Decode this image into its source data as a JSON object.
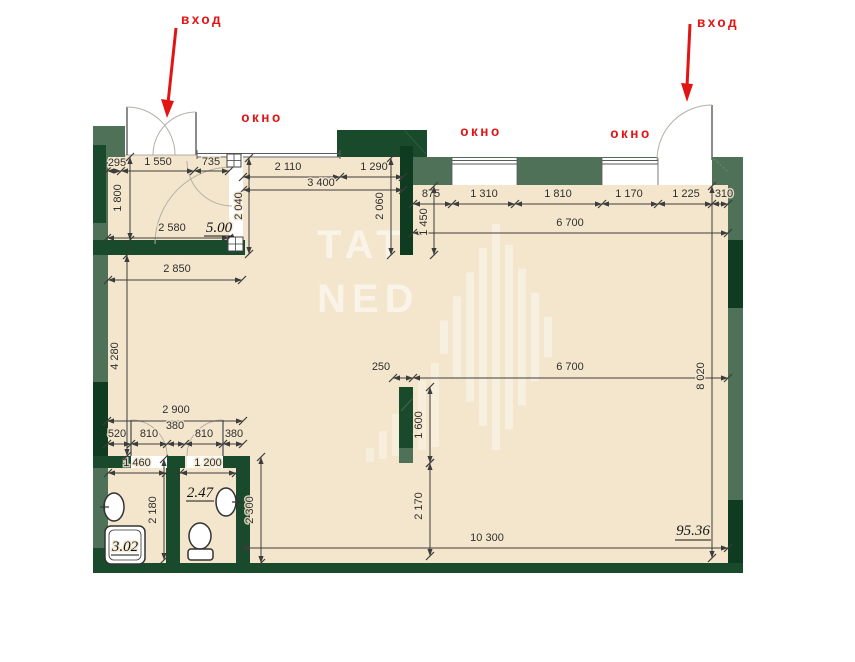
{
  "labels": {
    "entrance_left": "вход",
    "entrance_right": "вход",
    "window_1": "окно",
    "window_2": "окно",
    "window_3": "окно"
  },
  "areas": {
    "vestibule": "5.00",
    "shower_room": "3.02",
    "wc": "2.47",
    "main_room": "95.36"
  },
  "watermark": {
    "line1": "TAT",
    "line2": "NED"
  },
  "dims": {
    "d295": "295",
    "d1550": "1 550",
    "d735": "735",
    "d1800": "1 800",
    "d2580": "2 580",
    "d2040": "2 040",
    "d2110": "2 110",
    "d1290": "1 290",
    "d3400": "3 400",
    "d875": "875",
    "d1310": "1 310",
    "d1810": "1 810",
    "d1170": "1 170",
    "d1225": "1 225",
    "d310": "310",
    "d2060": "2 060",
    "d1450": "1 450",
    "d6700_top": "6 700",
    "d2850": "2 850",
    "d4280": "4 280",
    "d250": "250",
    "d6700_mid": "6 700",
    "d1600": "1 600",
    "d8020": "8 020",
    "d2900": "2 900",
    "d380_mid": "380",
    "d520": "520",
    "d810_left": "810",
    "d810_right": "810",
    "d380_right": "380",
    "d1460": "1 460",
    "d1200": "1 200",
    "d2180": "2 180",
    "d2300": "2 300",
    "d2170": "2 170",
    "d10300": "10 300"
  },
  "colors": {
    "floor": "#f3e6cc",
    "wall_medium": "#4f7158",
    "wall_dark": "#1a4a2c",
    "wall_deep": "#0f3b20",
    "accent_red": "#e21414"
  }
}
